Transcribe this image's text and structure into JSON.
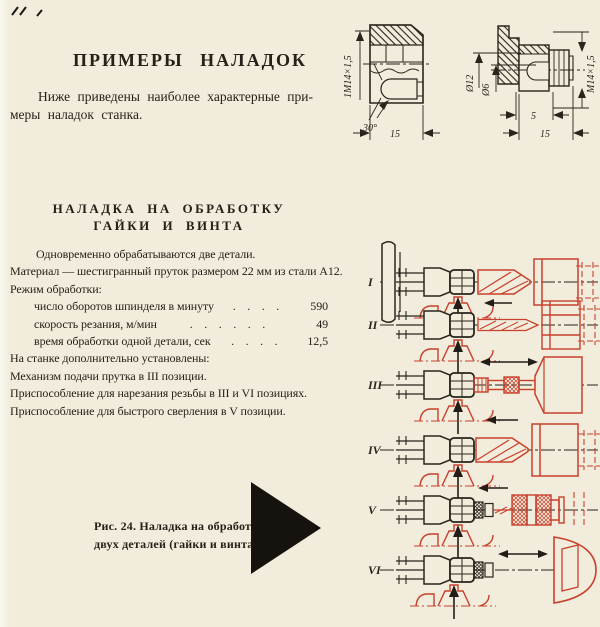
{
  "page": {
    "title": "ПРИМЕРЫ НАЛАДОК",
    "intro_lines": [
      "Ниже приведены наиболее характерные при-",
      "меры наладок станка."
    ]
  },
  "section": {
    "heading_lines": [
      "НАЛАДКА НА ОБРАБОТКУ",
      "ГАЙКИ И ВИНТА"
    ],
    "p_intro": "Одновременно обрабатываются две детали.",
    "p_material": "Материал — шестигранный пруток размером 22 мм из стали А12.",
    "p_mode": "Режим обработки:",
    "specs": [
      {
        "label": "число оборотов шпинделя в минуту",
        "dots": ".    .    .    .",
        "value": "590"
      },
      {
        "label": "скорость резания, м/мин",
        "dots": ".    .    .    .    .    .",
        "value": "49"
      },
      {
        "label": "время обработки одной детали, сек",
        "dots": ".    .    .    .",
        "value": "12,5"
      }
    ],
    "notes": [
      "На станке дополнительно установлены:",
      "Механизм подачи прутка в III позиции.",
      "Приспособление для нарезания резьбы в III и VI позициях.",
      "Приспособление для быстрого сверления в V позиции."
    ]
  },
  "figure": {
    "caption_lines": [
      "Рис. 24. Наладка на обработку",
      "двух деталей (гайки и винта)"
    ],
    "positions": [
      "I",
      "II",
      "III",
      "IV",
      "V",
      "VI"
    ]
  },
  "drawings": {
    "nut": {
      "thread": "1М14×1,5",
      "angle": "30°",
      "width": "15"
    },
    "screw": {
      "d12": "Ø12",
      "d6": "Ø6",
      "thread": "М14×1,5",
      "step": "5",
      "width": "15"
    }
  },
  "colors": {
    "ink": "#262019",
    "red": "#c8402c",
    "paper": "#f1ecdb"
  }
}
